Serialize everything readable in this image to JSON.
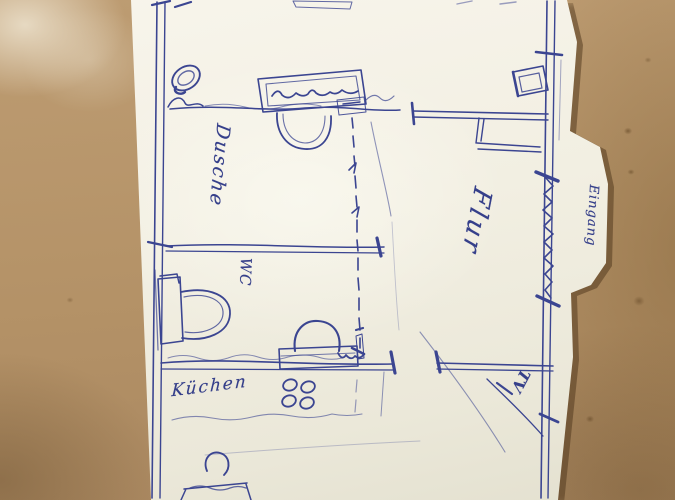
{
  "scene": {
    "kind": "hand-drawn floor plan sketch, blue ballpoint on white paper, photographed on tan board",
    "colors": {
      "ink": "#3b4591",
      "paper": "#f2efe2",
      "board": "#b29166"
    }
  },
  "labels": {
    "dusche": "Dusche",
    "wc": "WC",
    "flur": "Flur",
    "eingang": "Eingang",
    "kueche": "Küchen",
    "tv": "TV"
  }
}
